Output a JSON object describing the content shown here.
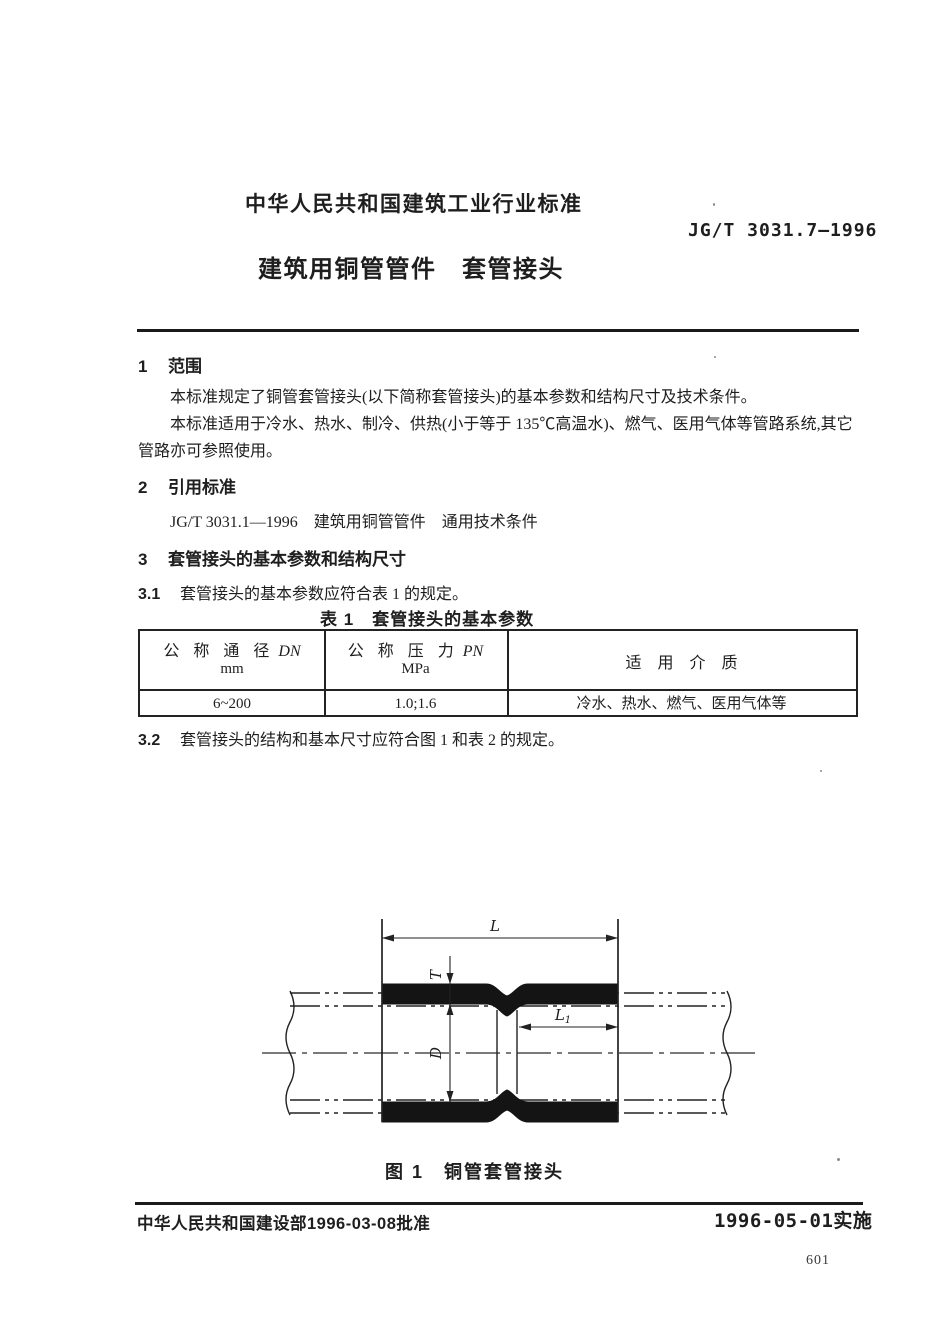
{
  "header": {
    "org_line": "中华人民共和国建筑工业行业标准",
    "standard_no": "JG/T 3031.7—1996",
    "title": "建筑用铜管管件　套管接头"
  },
  "scope": {
    "num": "1",
    "heading": "范围",
    "p1": "本标准规定了铜管套管接头(以下简称套管接头)的基本参数和结构尺寸及技术条件。",
    "p2": "本标准适用于冷水、热水、制冷、供热(小于等于 135℃高温水)、燃气、医用气体等管路系统,其它管路亦可参照使用。"
  },
  "references": {
    "num": "2",
    "heading": "引用标准",
    "item": "JG/T 3031.1—1996　建筑用铜管管件　通用技术条件"
  },
  "params": {
    "num": "3",
    "heading": "套管接头的基本参数和结构尺寸",
    "s31_num": "3.1",
    "s31_text": "套管接头的基本参数应符合表 1 的规定。",
    "s32_num": "3.2",
    "s32_text": "套管接头的结构和基本尺寸应符合图 1 和表 2 的规定。"
  },
  "table1": {
    "caption": "表 1　套管接头的基本参数",
    "col1_name": "公 称 通 径",
    "col1_symbol": "DN",
    "col1_unit": "mm",
    "col2_name": "公 称 压 力",
    "col2_symbol": "PN",
    "col2_unit": "MPa",
    "col3_name": "适　用　介　质",
    "row_dn": "6~200",
    "row_pn": "1.0;1.6",
    "row_media": "冷水、热水、燃气、医用气体等"
  },
  "figure": {
    "caption": "图 1　铜管套管接头",
    "dim_L": "L",
    "dim_T": "T",
    "dim_D": "D",
    "dim_L1_base": "L",
    "dim_L1_sub": "1"
  },
  "footer": {
    "approval": "中华人民共和国建设部1996-03-08批准",
    "implementation": "1996-05-01实施",
    "page_number": "601"
  }
}
